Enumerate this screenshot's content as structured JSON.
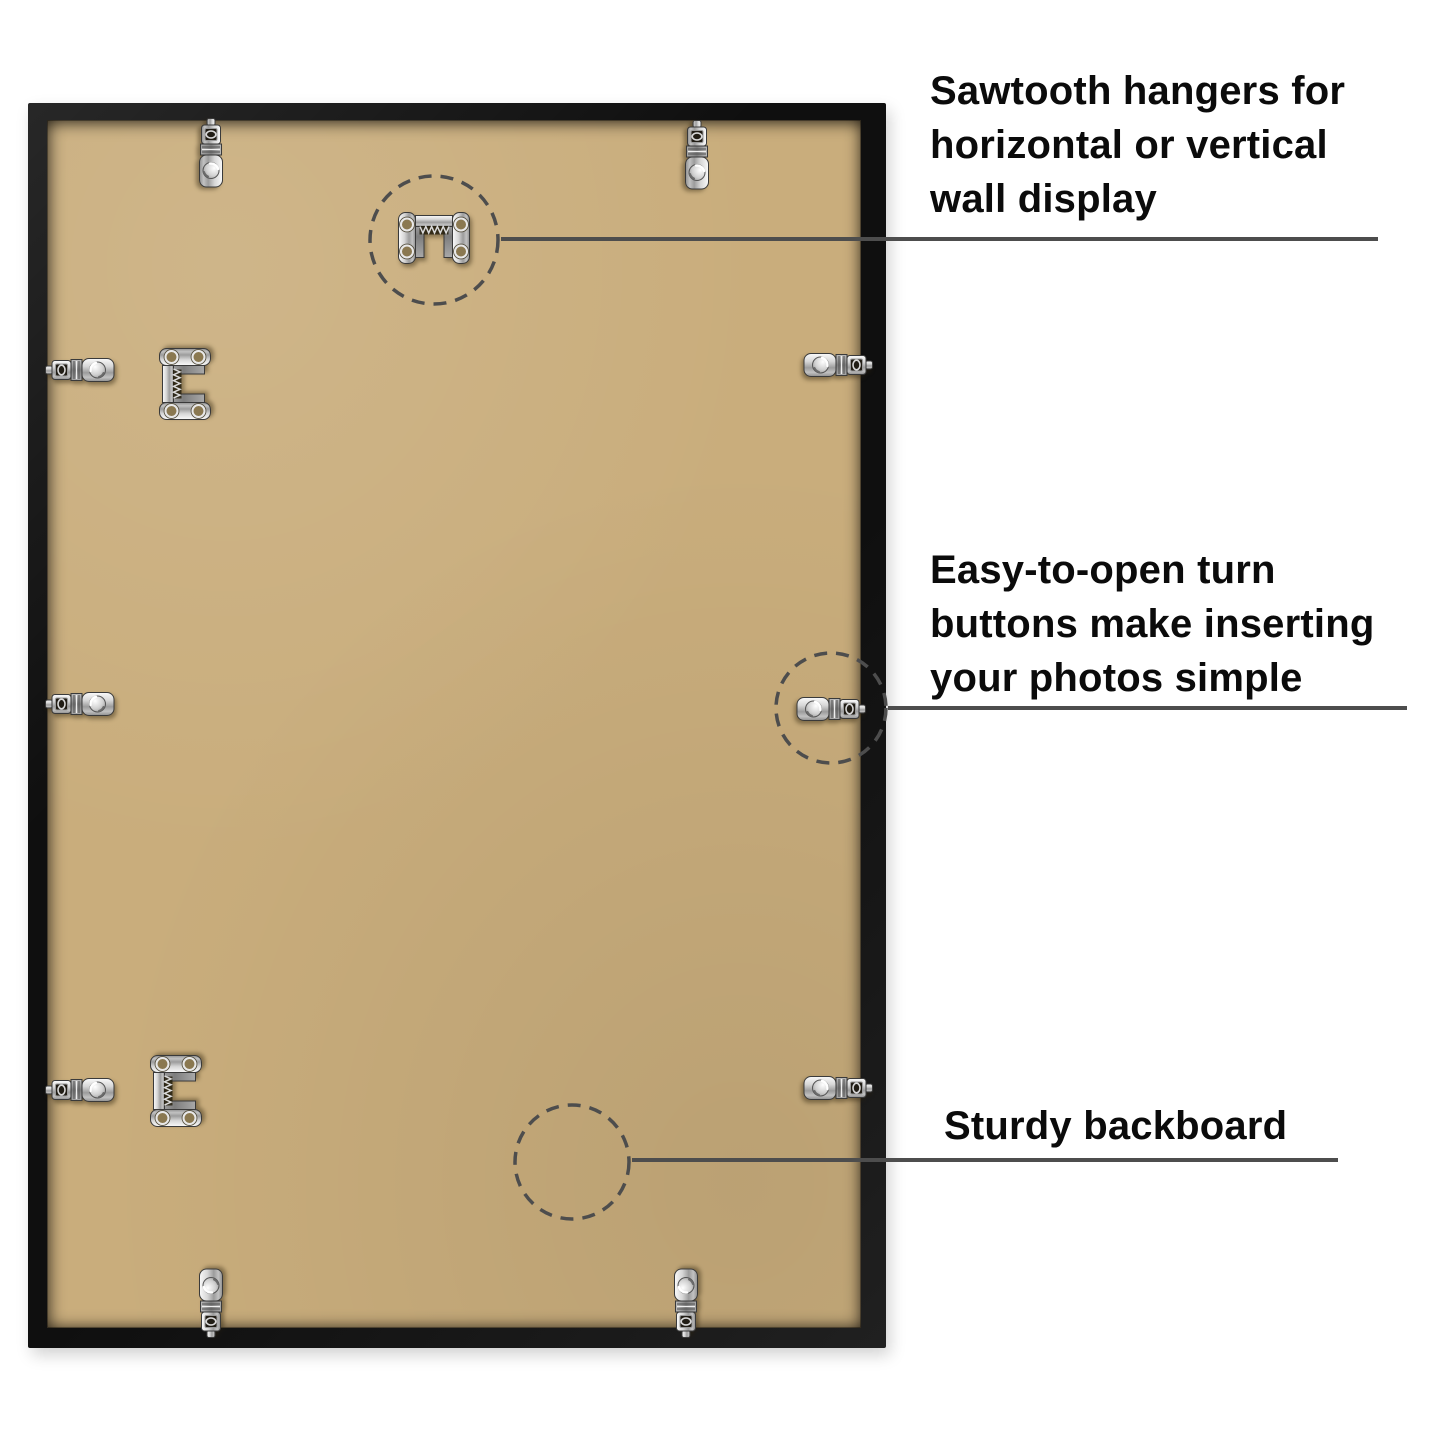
{
  "canvas": {
    "width": 1440,
    "height": 1441,
    "background": "#ffffff"
  },
  "colors": {
    "bg": "#ffffff",
    "text": "#0b0b0b",
    "callout": "#4d4d4d",
    "frame": "#141414",
    "backboard": "#c9ad7c",
    "metal_light": "#f2f2f2",
    "metal_dark": "#8f8f8f"
  },
  "hardware": {
    "sawtooth_hanger_name": "sawtooth-hanger",
    "sawtooth_hanger_count": 3,
    "turn_button_name": "turn-button",
    "turn_button_count": 10
  },
  "callouts": [
    {
      "target": "sawtooth-hanger",
      "lines": [
        "Sawtooth hangers for",
        "horizontal or vertical",
        "wall display"
      ]
    },
    {
      "target": "turn-button",
      "lines": [
        "Easy-to-open turn",
        "buttons make inserting",
        "your photos simple"
      ]
    },
    {
      "target": "backboard",
      "lines": [
        "Sturdy backboard"
      ]
    }
  ]
}
